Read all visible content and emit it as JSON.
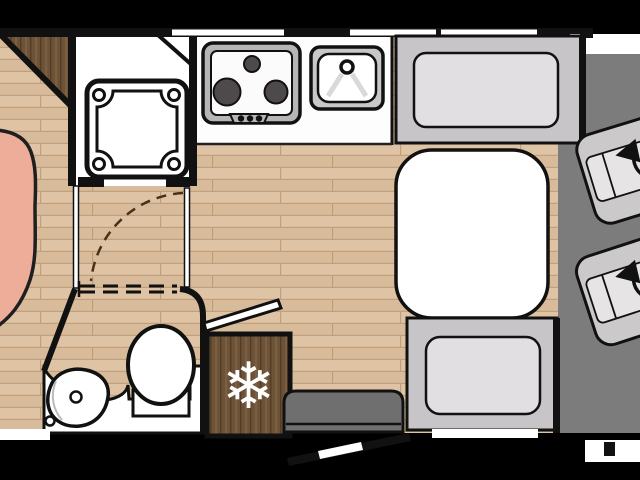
{
  "scene": {
    "title": "motorhome-floorplan-top-view",
    "description": "Overhead floor plan of a motorhome interior, letterboxed on black"
  },
  "icons": {
    "snowflake": "❄",
    "swivel_arrow": "rotate-ccw-arrow"
  },
  "colors": {
    "background": "#000000",
    "floor_wood": "#dcc1a2",
    "floor_plank_line": "#c2a07b",
    "dark_wood": "#6c5338",
    "wall": "#111111",
    "cab_floor": "#7d7c7d",
    "bench_frame": "#c7c5c7",
    "cushion": "#e1dfe1",
    "seat": "#cbc9ca",
    "bed": "#edad98",
    "fixture_white": "#ffffff",
    "appliance_gray": "#b7b5b6",
    "burner_gray": "#4e4a4b",
    "step_gray": "#6f6f6f",
    "door_arc_brown": "#4a3018"
  },
  "fixtures": {
    "front_cab": [
      "driver-swivel-seat",
      "passenger-swivel-seat"
    ],
    "kitchen": [
      "hob-3-burner",
      "sink-with-tap",
      "fridge-freezer"
    ],
    "dinette": [
      "bench-seat-top",
      "table",
      "bench-seat-bottom"
    ],
    "washroom": [
      "shower-tray",
      "toilet",
      "washbasin",
      "vanity-counter",
      "door-swing-arc"
    ],
    "bedroom": [
      "bed-corner",
      "wardrobe-corner"
    ],
    "entry": [
      "entry-step",
      "open-entry-door",
      "open-locker-flap"
    ],
    "windows": [
      "window-left",
      "window-mid",
      "window-right",
      "windshield-strip",
      "rear-bottom-window",
      "dinette-bottom-window"
    ]
  }
}
